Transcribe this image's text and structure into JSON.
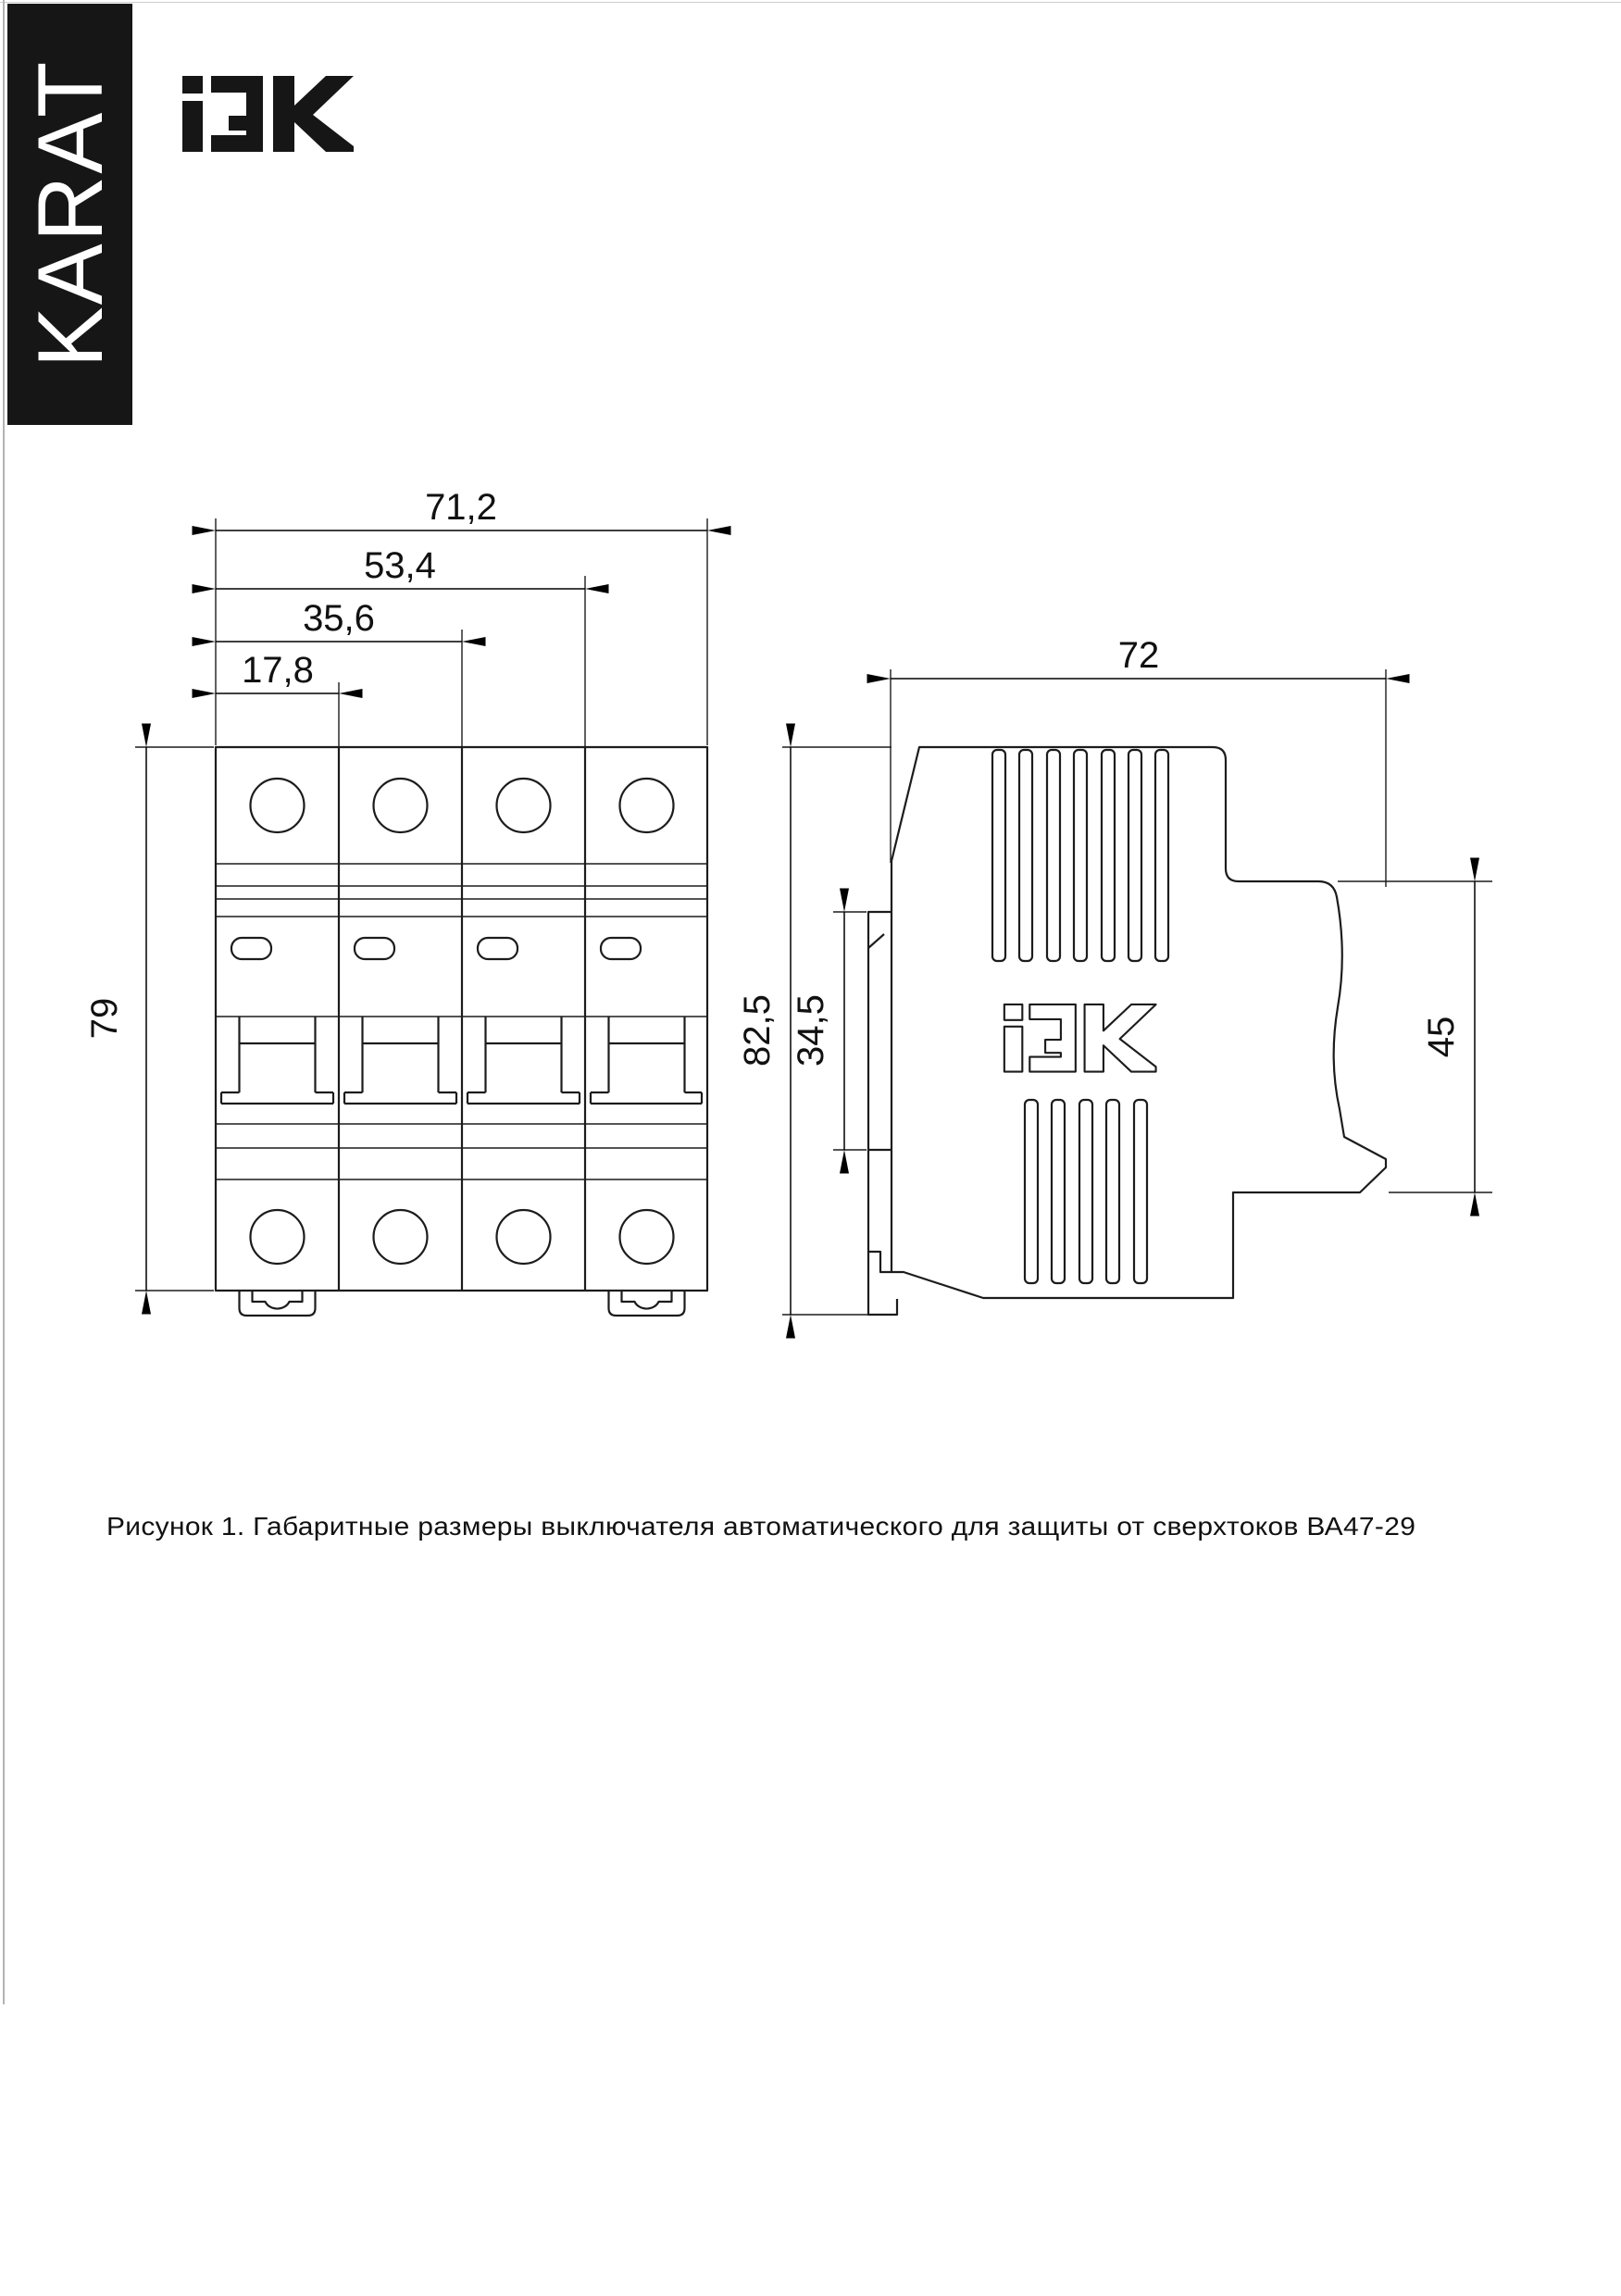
{
  "document": {
    "caption": "Рисунок 1. Габаритные размеры выключателя автоматического для защиты от сверхтоков ВА47-29"
  },
  "brand": {
    "karat_label": "KARAT",
    "iek_title": "IEK"
  },
  "front_view": {
    "dim_width_total": "71,2",
    "dim_width_3mod": "53,4",
    "dim_width_2mod": "35,6",
    "dim_width_1mod": "17,8",
    "dim_height": "79"
  },
  "side_view": {
    "dim_width": "72",
    "dim_height_total": "82,5",
    "dim_rail_height": "34,5",
    "dim_front_height": "45"
  },
  "colors": {
    "ink": "#1c1c1c",
    "bar_background": "#161616",
    "bar_text": "#ffffff",
    "page_background": "#ffffff"
  }
}
